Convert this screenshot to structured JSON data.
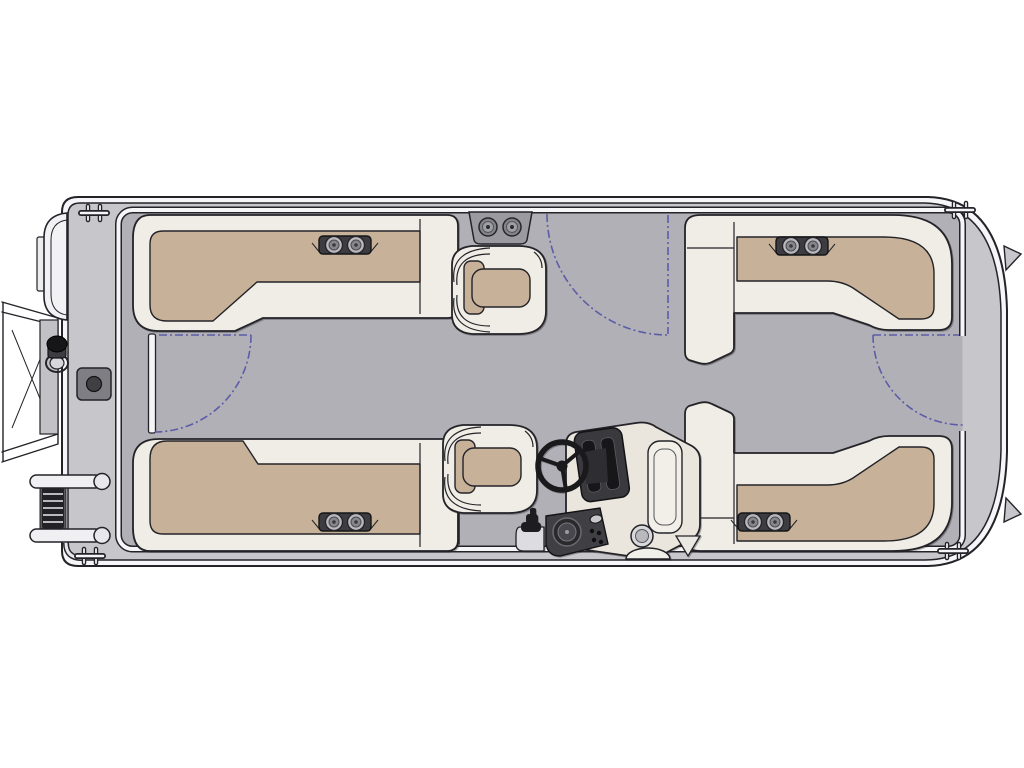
{
  "canvas": {
    "width": 1024,
    "height": 768
  },
  "document": {
    "type": "floorplan-diagram",
    "subject": "pontoon boat deck plan, top view",
    "orientation": "bow at right, stern at left",
    "visible_text": "none"
  },
  "colors": {
    "page_bg": "#ffffff",
    "outline": "#232328",
    "ink": "#141417",
    "trim": "#f6f5f7",
    "band": "#c7c6cb",
    "deck": "#b1b0b6",
    "upholstery": "#f0ede6",
    "cushion": "#c7b299",
    "panel_gray": "#9b9aa1",
    "hardware_dark": "#3c3c41",
    "box_gray": "#7f7e85",
    "metal_light": "#c6c5ca",
    "gate_arc": "#5c5ca8"
  },
  "components": {
    "hull": "Pontoon hull with rub rail",
    "deck": "Main deck",
    "fence": "Perimeter fence",
    "sternGate": "Stern gate",
    "portGate": "Port side gate",
    "bowGate": "Bow gate",
    "gateSwing": "Gate swing path",
    "motor": "Outboard motor",
    "towFrame": "Stern tow frame",
    "pylon": "Ski pylon",
    "deckBox": "Deck storage box",
    "ladder": "Folded boarding ladder",
    "grabHandle": "Grab handle",
    "railFitting": "Stern rail fitting",
    "cleat": "Mooring cleat",
    "noseCone": "Bow nose cone tip",
    "loungeAftPort": "Aft port L-shaped lounge",
    "loungeAftStbd": "Aft starboard L-shaped lounge",
    "loungeBowPort": "Forward port L-shaped lounge",
    "loungeBowStbd": "Forward starboard L-shaped lounge",
    "cupholders": "Twin cup holders",
    "speakers": "Dual speaker panel",
    "recliner": "Companion recliner chair",
    "captain": "Captain recliner chair",
    "pedestal": "Chair pedestal mark",
    "helm": "Helm console",
    "wheel": "Steering wheel",
    "dash": "Instrument panel",
    "sidePanel": "Helm side panel with speaker and switches",
    "throttle": "Throttle control",
    "helmCup": "Helm cup holder",
    "step": "Helm step"
  },
  "counts": {
    "lounges": 4,
    "recliner_chairs": 2,
    "gates": 3,
    "cleats": 4,
    "cup_holder_pairs": 4
  }
}
